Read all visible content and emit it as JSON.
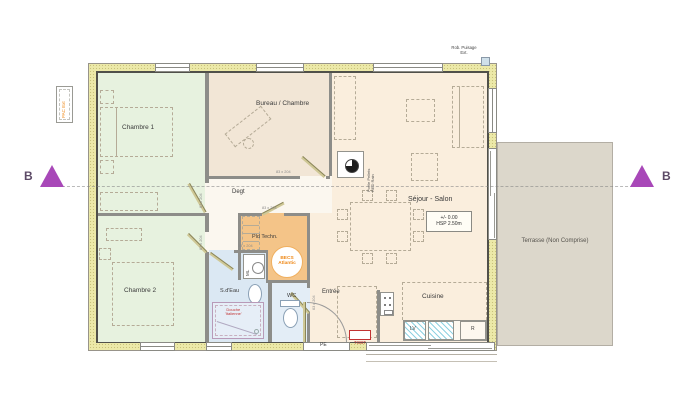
{
  "section_markers": {
    "left": "B",
    "right": "B"
  },
  "exterior": {
    "tap_line1": "Rob. Puisage",
    "tap_line2": "Ext.",
    "pac": "PAC Ext"
  },
  "rooms": {
    "chambre1": "Chambre 1",
    "bureau": "Bureau / Chambre",
    "degt": "Degt",
    "chambre2": "Chambre 2",
    "sdeau": "S.d'Eau",
    "wc": "WC",
    "entree": "Entrée",
    "cuisine": "Cuisine",
    "sejour": "Séjour - Salon",
    "pld": "Pld Techn.",
    "terrasse": "Terrasse (Non Comprise)"
  },
  "levels": {
    "elevation": "+/- 0.00",
    "height": "HSP 2.50m"
  },
  "equipment": {
    "becs1": "BECS",
    "becs2": "Atlantic",
    "ml": "ML",
    "lv": "LV",
    "fridge": "R",
    "entry_door": "PE",
    "tgbt": "TGBT",
    "stove1": "Poêle Pellets",
    "stove2": "RED Rain",
    "shower1": "Douche",
    "shower2": "'Italienne'"
  },
  "dimensions": {
    "door_std": "83 x 204",
    "door_wc": "63 x 204"
  },
  "colors": {
    "wall_insulation": "#ece9a8",
    "wall_line": "#50504a",
    "bedroom": "#e7f2df",
    "office": "#f2e6d6",
    "living": "#faeedd",
    "tech": "#f4c488",
    "bath": "#dbe8f3",
    "wc": "#e3edf6",
    "terrace": "#dcd7cb",
    "marker": "#a848b8",
    "alert_red": "#c23333",
    "orange_text": "#ef8a1a"
  }
}
